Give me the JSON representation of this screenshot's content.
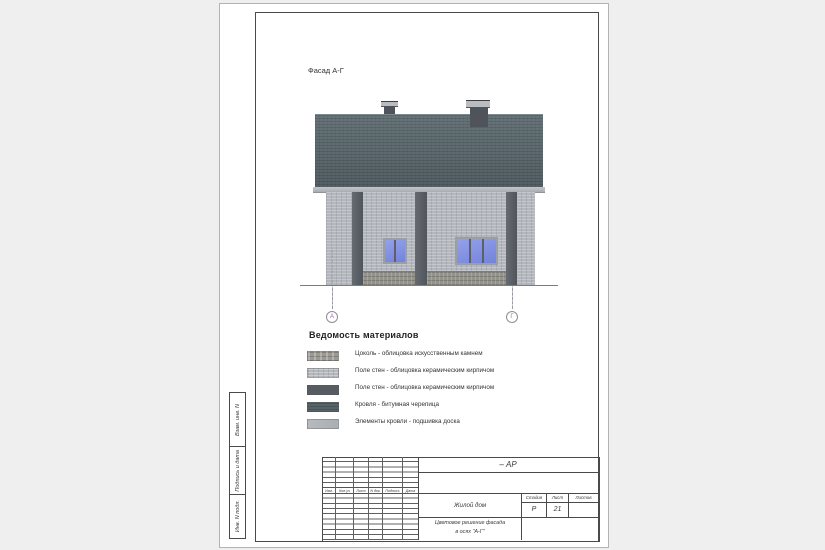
{
  "sheet": {
    "facade_label": "Фасад А-Г",
    "axes": {
      "left": "А",
      "right": "Г"
    },
    "materials": {
      "title": "Ведомость материалов",
      "items": [
        {
          "swatch": "stone",
          "label": "Цоколь - облицовка искусственным камнем"
        },
        {
          "swatch": "light-brick",
          "label": "Поле стен - облицовка керамическим кирпичом"
        },
        {
          "swatch": "dark-brick",
          "label": "Поле стен - облицовка керамическим кирпичом"
        },
        {
          "swatch": "roof",
          "label": "Кровля - битумная черепица"
        },
        {
          "swatch": "light",
          "label": "Элементы кровли - подшивка доска"
        }
      ]
    },
    "side_strip": {
      "cells": [
        "Взам. инв. N",
        "Подпись и дата",
        "Инв. N подл."
      ]
    },
    "titleblock": {
      "doc_code": "– АР",
      "project": "Жилой дом",
      "sheet_title_line1": "Цветовое решение фасада",
      "sheet_title_line2": "в осях \"А-Г\"",
      "stage_label": "Стадия",
      "stage_value": "Р",
      "sheet_label": "Лист",
      "sheet_value": "21",
      "sheets_label": "Листов",
      "sheets_value": "",
      "revision_headers": [
        "Изм.",
        "Кол.уч",
        "Лист",
        "N док.",
        "Подпись",
        "Дата"
      ]
    },
    "colors": {
      "roof": "#5d6b71",
      "wall": "#b3b7bd",
      "pilaster": "#585d64",
      "plinth": "#94938c",
      "fascia": "#b9bdc1",
      "window_glass": "#7c8bdf",
      "axis_letter": "#b35cc6"
    }
  }
}
